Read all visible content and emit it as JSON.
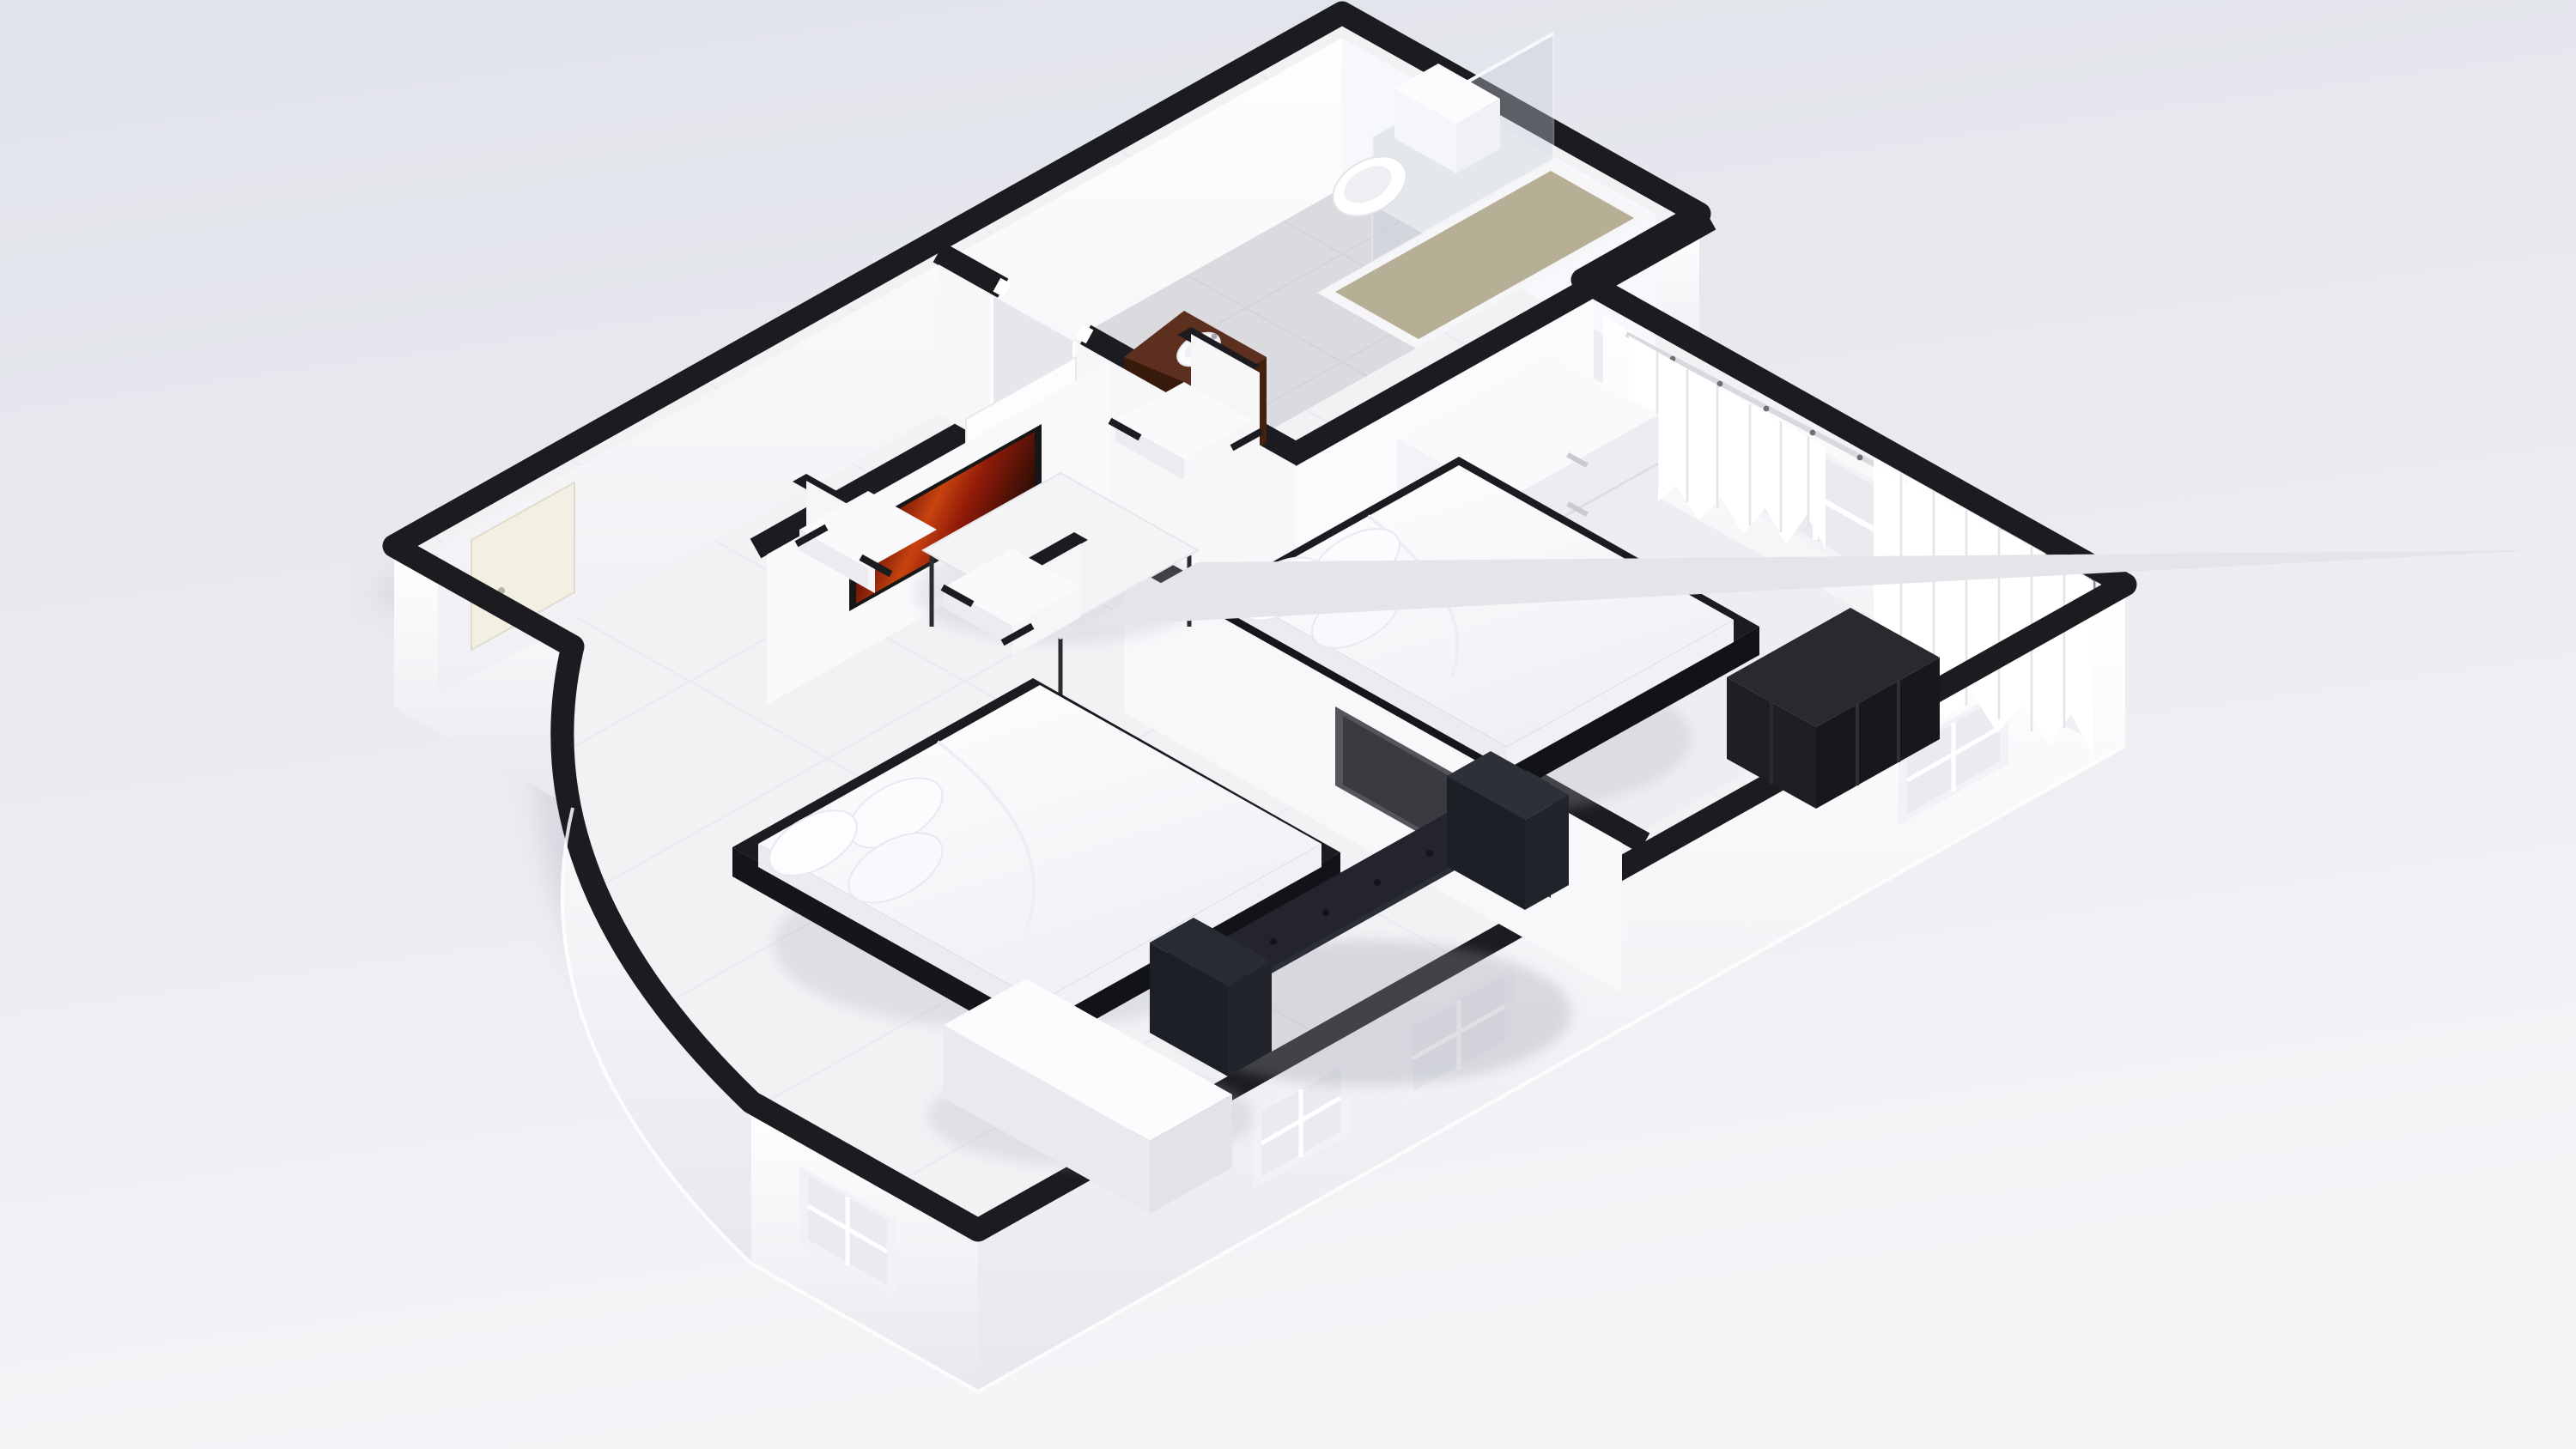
{
  "meta": {
    "kind": "isometric-3d-floor-plan-render",
    "description": "Top-down isometric 3D rendering of a one-bedroom apartment floor plan on a plain light background. No text labels are visible.",
    "text_visible": false
  },
  "colors": {
    "bg_top": "#e2e4ec",
    "bg_bottom": "#f4f4f7",
    "wall_cap": "#1b1c1f",
    "wall_face": "#fdfdfe",
    "wall_face_shade": "#eef0f4",
    "floor_main": "#f2f2f5",
    "floor_bathroom": "#dbdbdf",
    "floor_bedroom": "#eeeef2",
    "tile_line": "#e6e7ed",
    "shadow": "#c3c5cf",
    "glass": "#c6cfd9",
    "shower_floor": "#b6ae95",
    "toilet": "#ffffff",
    "vanity_top": "#5d2f1e",
    "vanity_front": "#45220f",
    "vanity_side": "#371a09",
    "sink": "#fcfcfd",
    "door_leaf": "#f3efe2",
    "bath_door_leaf": "#fdfdfe",
    "dresser": "#fafafc",
    "shelf_top": "#282a30",
    "shelf_front": "#17181d",
    "shelf_side": "#1d1f24",
    "bed_frame": "#1b1c20",
    "mattress": "#ffffff",
    "mattress_side": "#ededf1",
    "pillow": "#fbfcfe",
    "curtain": "#ffffff",
    "curtain_rod": "#d8d9de",
    "window_frame": "#f2f3f7",
    "window_pane": "#e9ebf0",
    "tv_panel": "#55565c",
    "tv_screen": "#3a3b41",
    "phone": "#26272c",
    "art_frame": "#161616",
    "art_red": "#8f1a08",
    "art_orange": "#d35414",
    "table": "#f4f4f7",
    "chair": "#fafafc",
    "chair_accent": "#1c1c20",
    "bench_top": "#fcfcfe",
    "bench_side": "#e9e9ee",
    "sofa_top": "#2e3039",
    "sofa_seat": "#2b2d37",
    "sofa_front": "#23242e",
    "sofa_dark": "#1d1f27",
    "sofa_button": "#13141a"
  },
  "scene": {
    "rooms": [
      {
        "name": "bathroom",
        "items": [
          "toilet",
          "walk-in-shower-with-glass-panel",
          "dark-wood-vanity-with-round-sink",
          "open-door-leaf"
        ]
      },
      {
        "name": "bedroom",
        "items": [
          "double-bed-black-frame",
          "three-pillows",
          "white-dresser",
          "black-cube-shelf",
          "sheer-curtains",
          "curtain-rod",
          "window"
        ]
      },
      {
        "name": "living-dining",
        "items": [
          "square-dining-table",
          "dining-chair",
          "dining-chair",
          "dining-chair",
          "red-abstract-wall-art",
          "wall-mounted-tv",
          "wall-phone",
          "double-bed-black-frame",
          "three-pillows",
          "long-white-bench",
          "black-tufted-sofa"
        ]
      },
      {
        "name": "entry-nook",
        "items": [
          "front-door",
          "curved-exterior-wall"
        ]
      }
    ],
    "exterior": [
      "white-exterior-walls",
      "faint-four-pane-windows",
      "soft-ground-shadow"
    ],
    "chair_count": 3,
    "pillow_count_per_bed": 3
  }
}
